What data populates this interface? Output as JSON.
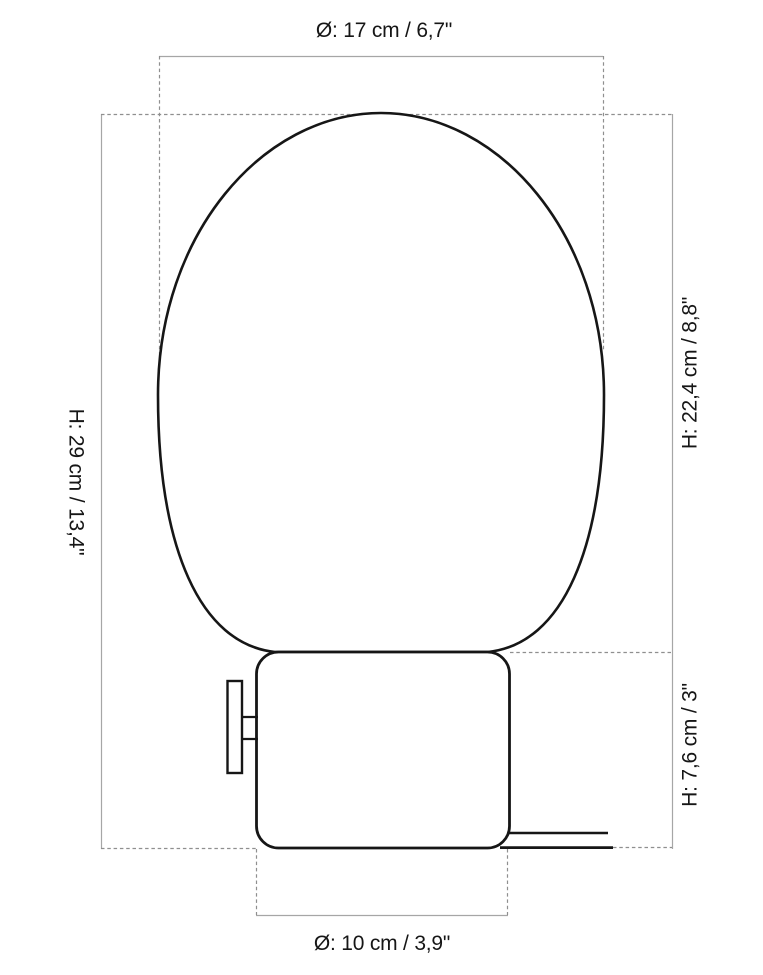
{
  "diagram": {
    "labels": {
      "globe_diameter": "Ø: 17 cm / 6,7\"",
      "total_height": "H: 29 cm / 13,4\"",
      "globe_height": "H: 22,4 cm / 8,8\"",
      "base_height": "H: 7,6 cm / 3\"",
      "base_diameter": "Ø: 10 cm / 3,9\""
    }
  },
  "colors": {
    "outline": "#161616",
    "dimension_line": "#a6a6a6",
    "dash_line": "#8f8f8f",
    "text": "#161616",
    "background": "#ffffff"
  }
}
